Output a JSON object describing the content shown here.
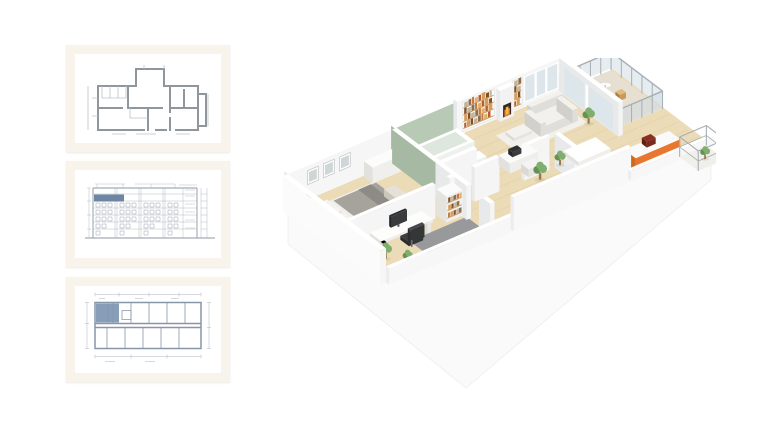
{
  "page": {
    "background_color": "#ffffff"
  },
  "gallery": {
    "items": [
      {
        "name": "apartment-floor-plan-thumbnail",
        "kind": "2d-apartment-floor-plan-drawing",
        "frame_color": "#f8f3eb",
        "paper_color": "#ffffff",
        "line_color": "#8f969c",
        "line_color_light": "#bcc1c6"
      },
      {
        "name": "building-elevation-thumbnail",
        "kind": "building-elevation-drawing",
        "frame_color": "#f8f3eb",
        "paper_color": "#ffffff",
        "line_color": "#8d97a3",
        "line_color_light": "#aab3bc",
        "highlight_color": "#6d86a3"
      },
      {
        "name": "building-level-plan-thumbnail",
        "kind": "building-level-floor-plan-drawing",
        "frame_color": "#f8f3eb",
        "paper_color": "#ffffff",
        "line_color": "#8796a8",
        "line_color_light": "#a9b4c0",
        "highlight_color": "#7a93b0"
      }
    ]
  },
  "render": {
    "name": "apartment-3d-cutaway-floor-plan",
    "rooms": [
      "bedroom",
      "bathroom",
      "living-room",
      "kitchen-dining",
      "home-office",
      "hallway",
      "balcony",
      "terrace"
    ],
    "colors": {
      "wall": "#ffffff",
      "wall_front": "#f5f5f6",
      "wall_side": "#e8e9eb",
      "wall_deep": "#dfe0e3",
      "slab": "#fafafb",
      "slab_edge": "#f0f0f2",
      "floor": "#ebdbb7",
      "floor_shade": "#e0cda6",
      "bath_wall": "#b8c9b5",
      "bath_wall_dark": "#a6baa3",
      "bath_floor": "#cbd7c6",
      "tub_inner": "#dde7dd",
      "glass": "#dde6ea",
      "metal": "#a7afb5",
      "wood": "#c89a5e",
      "wood_dark": "#b07f42",
      "books": [
        "#b65c35",
        "#d89c55",
        "#7d4f2b",
        "#c0b49c",
        "#8a6f4e",
        "#cf7443",
        "#e0b068"
      ],
      "fire": "#e8832f",
      "fire_glow": "#f6b544",
      "hearth": "#342a22",
      "sofa": "#f2f1ee",
      "sofa_shade": "#e0deda",
      "sofa_dark": "#d2d0ca",
      "duvet": "#a6a39d",
      "duvet_dark": "#908d88",
      "throw_blanket": "#8e8b86",
      "linen": "#efeeea",
      "rug": "#97999b",
      "rug_light": "#f2f0ea",
      "accent_orange": "#e8762e",
      "accent_red": "#8a2f22",
      "leaf": "#7fae6e",
      "leaf_dark": "#639253",
      "trunk": "#9b7b4e",
      "dark_furniture": "#3c3d3f",
      "screen": "#2f3032",
      "balcony_floor": "#e7e0d2"
    }
  }
}
